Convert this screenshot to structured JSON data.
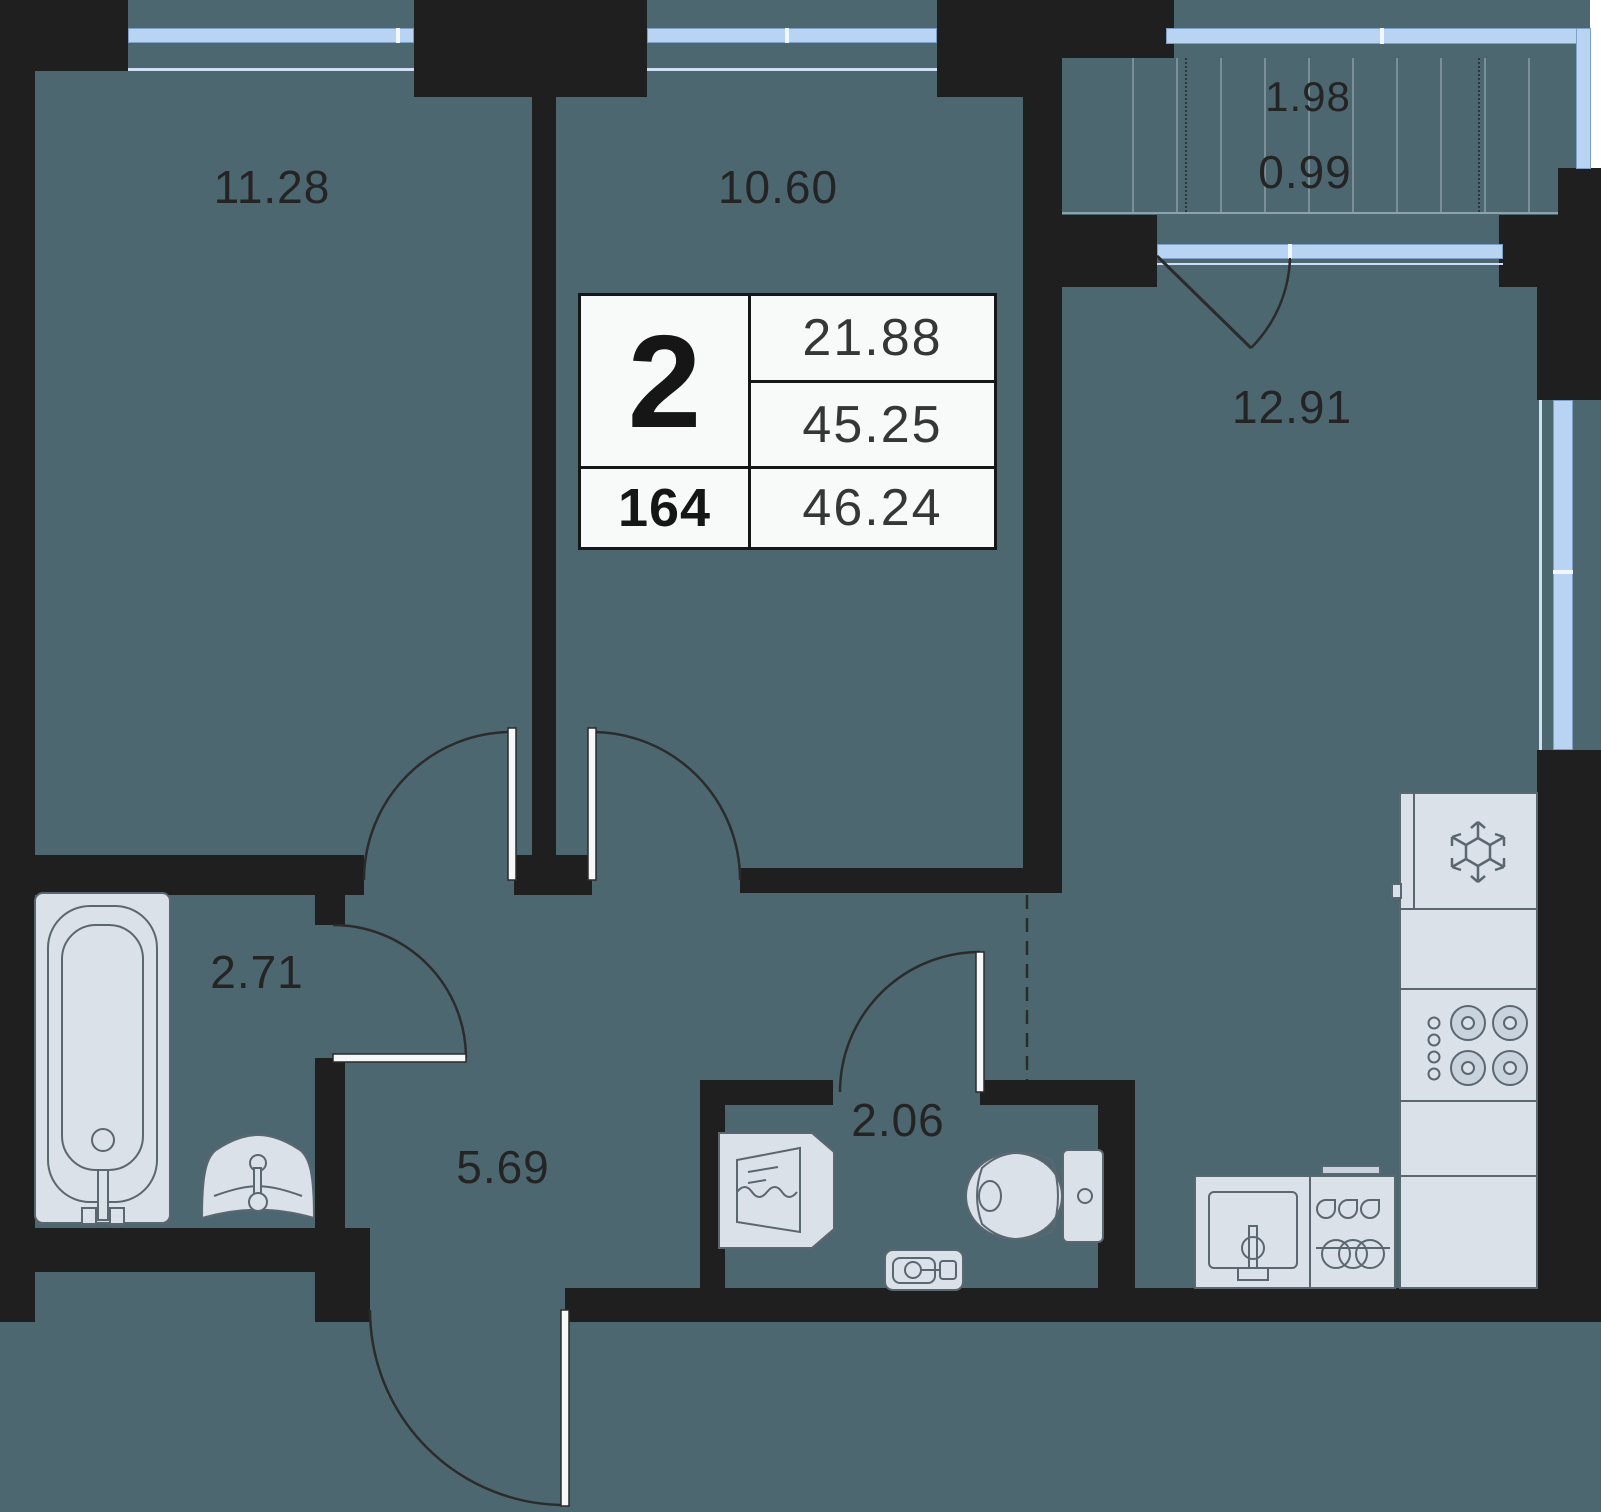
{
  "plan_title": "2-room apartment floor plan",
  "rooms": {
    "living_room_1": "11.28",
    "living_room_2": "10.60",
    "kitchen_living": "12.91",
    "bathroom": "2.71",
    "hallway": "5.69",
    "wc": "2.06",
    "balcony": "1.98",
    "balcony_coeff": "0.99"
  },
  "info_box": {
    "rooms_count": "2",
    "unit_number": "164",
    "living_area": "21.88",
    "apartment_area": "45.25",
    "total_area": "46.24"
  },
  "colors": {
    "floor": "#4d6771",
    "wall": "#1f1f1f",
    "window_glass": "#b9d4f2",
    "window_frame": "#7e9fc6",
    "fixture_fill": "#dbe1e8",
    "fixture_stroke": "#5b6770",
    "info_box_bg": "#f8f9f9",
    "label_text": "#242424"
  },
  "icons": {
    "fridge": "snowflake-icon",
    "stove": "burners-icon",
    "dishwasher": "dishwasher-icon",
    "sink": "faucet-icon"
  }
}
